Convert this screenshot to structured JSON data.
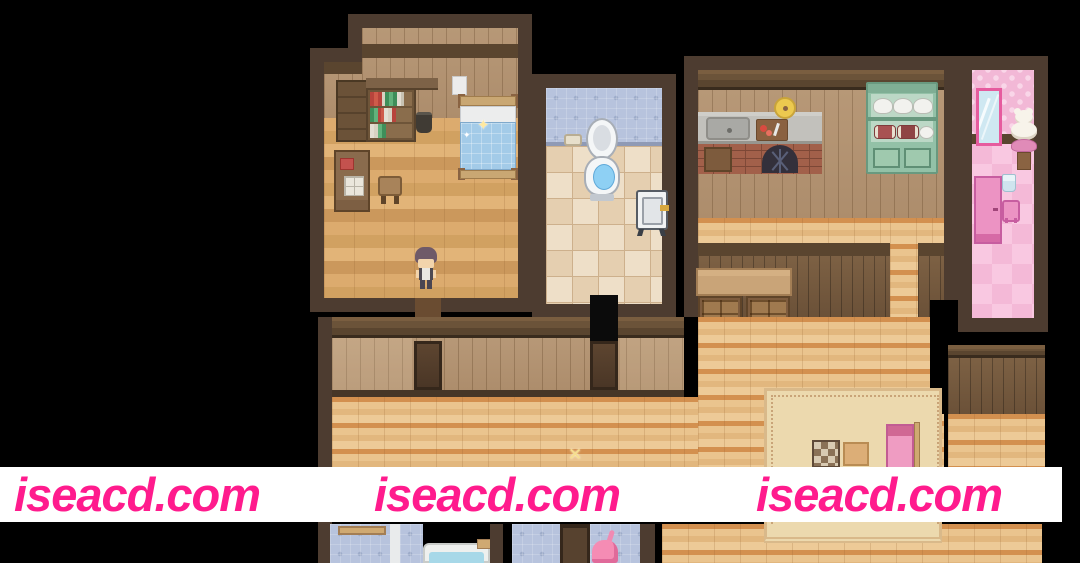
{
  "watermark": {
    "text_instances": [
      "iseacd.com",
      "iseacd.com",
      "iseacd.com"
    ],
    "color": "#ff1b8d",
    "band_color": "#ffffff"
  },
  "icons": {
    "sparkle_glyph": "✦",
    "x_sparkle_glyph": "✕"
  },
  "scene": {
    "description": "Top-down pixel-art house interior (RPG map)",
    "rooms": [
      "bedroom",
      "toilet-room",
      "kitchen",
      "pink-room",
      "hallway",
      "lower-bathroom",
      "living-area"
    ]
  },
  "palette": {
    "wall_border": "#4d3c30",
    "wood_beam": "#5a452f",
    "wall_planks": "#b29374",
    "floor_light": "#eac48e",
    "floor_orange": "#d3904f",
    "bedroom_floor": "#dcab6e",
    "tile_blue": "#b7c3dd",
    "tile_bath": "#eedfc8",
    "pink_wall": "#f2b8d6",
    "pink_floor": "#f6bedb",
    "hutch_green": "#93c1a7",
    "counter_gray": "#c2c1bc",
    "bed_blanket_blue": "#a3cbe8",
    "rug": "#ecd9ae"
  }
}
